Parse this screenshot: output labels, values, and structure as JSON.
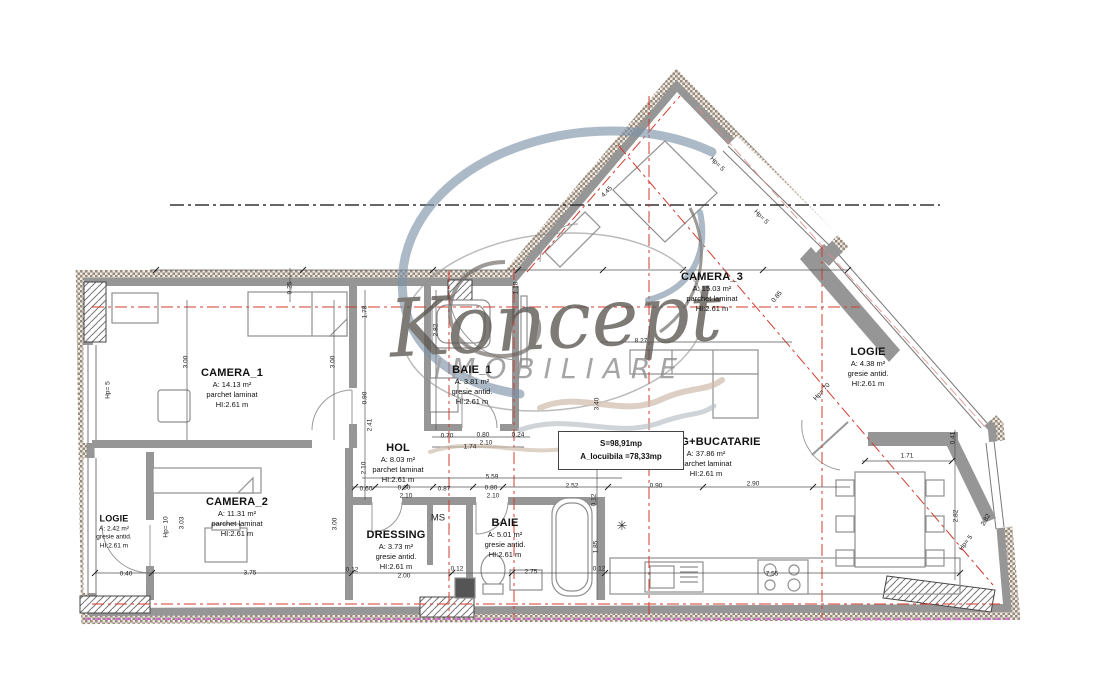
{
  "watermark": {
    "brand": "Koncept",
    "subtitle": "IMOBILIARE"
  },
  "summary_box": {
    "line1": "S=98,91mp",
    "line2": "A_locuibila =78,33mp"
  },
  "symbols": {
    "appliance": "✳"
  },
  "rooms": {
    "camera1": {
      "name": "CAMERA_1",
      "area": "A: 14.13 m²",
      "finish": "parchet laminat",
      "height": "HI:2.61 m"
    },
    "camera2": {
      "name": "CAMERA_2",
      "area": "A: 11.31 m²",
      "finish": "parchet laminat",
      "height": "HI:2.61 m"
    },
    "camera3": {
      "name": "CAMERA_3",
      "area": "A: 15.03 m²",
      "finish": "parchet laminat",
      "height": "HI:2.61 m"
    },
    "baie1": {
      "name": "BAIE_1",
      "area": "A: 3.81 m²",
      "finish": "gresie antid.",
      "height": "HI:2.61 m"
    },
    "hol": {
      "name": "HOL",
      "area": "A: 8.03 m²",
      "finish": "parchet laminat",
      "height": "HI:2.61 m"
    },
    "dressing": {
      "name": "DRESSING",
      "area": "A: 3.73 m²",
      "finish": "gresie antid.",
      "height": "HI:2.61 m"
    },
    "baie": {
      "name": "BAIE",
      "area": "A: 5.01 m²",
      "finish": "gresie antid.",
      "height": "HI:2.61 m"
    },
    "living": {
      "name": "LIVING+BUCATARIE",
      "area": "A: 37.86 m²",
      "finish": "parchet laminat",
      "height": "HI:2.61 m"
    },
    "logie_left": {
      "name": "LOGIE",
      "area": "A: 2.42 m²",
      "finish": "gresie antid.",
      "height": "HI:2.61 m"
    },
    "logie_right": {
      "name": "LOGIE",
      "area": "A: 4.38 m²",
      "finish": "gresie antid.",
      "height": "HI:2.61 m"
    },
    "ms": {
      "name": "MS"
    }
  },
  "dims": [
    {
      "t": "0.25",
      "x": 290,
      "y": 288,
      "r": -90
    },
    {
      "t": "3.00",
      "x": 186,
      "y": 362,
      "r": -90
    },
    {
      "t": "3.00",
      "x": 333,
      "y": 362,
      "r": -90
    },
    {
      "t": "1.78",
      "x": 365,
      "y": 312,
      "r": -90
    },
    {
      "t": "0.90",
      "x": 365,
      "y": 398,
      "r": -90
    },
    {
      "t": "2.41",
      "x": 370,
      "y": 425,
      "r": -90
    },
    {
      "t": "2.10",
      "x": 364,
      "y": 468,
      "r": -90
    },
    {
      "t": "2.82",
      "x": 436,
      "y": 330,
      "r": -90
    },
    {
      "t": "1.18",
      "x": 516,
      "y": 288,
      "r": -90
    },
    {
      "t": "0.70",
      "x": 447,
      "y": 436,
      "r": 0
    },
    {
      "t": "0.80",
      "x": 483,
      "y": 435,
      "r": 0
    },
    {
      "t": "2.10",
      "x": 486,
      "y": 443,
      "r": 0
    },
    {
      "t": "0.24",
      "x": 518,
      "y": 435,
      "r": 0
    },
    {
      "t": "1.74",
      "x": 470,
      "y": 447,
      "r": 0
    },
    {
      "t": "5.59",
      "x": 492,
      "y": 477,
      "r": 0
    },
    {
      "t": "0.60",
      "x": 366,
      "y": 489,
      "r": 0
    },
    {
      "t": "0.80",
      "x": 404,
      "y": 488,
      "r": 0
    },
    {
      "t": "2.10",
      "x": 406,
      "y": 496,
      "r": 0
    },
    {
      "t": "0.87",
      "x": 444,
      "y": 489,
      "r": 0
    },
    {
      "t": "0.80",
      "x": 491,
      "y": 488,
      "r": 0
    },
    {
      "t": "2.10",
      "x": 493,
      "y": 496,
      "r": 0
    },
    {
      "t": "2.52",
      "x": 572,
      "y": 486,
      "r": 0
    },
    {
      "t": "0.90",
      "x": 656,
      "y": 486,
      "r": 0
    },
    {
      "t": "2.90",
      "x": 753,
      "y": 484,
      "r": 0
    },
    {
      "t": "0.40",
      "x": 126,
      "y": 574,
      "r": 0
    },
    {
      "t": "3.75",
      "x": 250,
      "y": 573,
      "r": 0
    },
    {
      "t": "0.12",
      "x": 352,
      "y": 570,
      "r": 0
    },
    {
      "t": "2.00",
      "x": 404,
      "y": 576,
      "r": 0
    },
    {
      "t": "0.12",
      "x": 457,
      "y": 569,
      "r": 0
    },
    {
      "t": "2.75",
      "x": 531,
      "y": 572,
      "r": 0
    },
    {
      "t": "0.12",
      "x": 599,
      "y": 569,
      "r": 0
    },
    {
      "t": "7.55",
      "x": 772,
      "y": 574,
      "r": 0
    },
    {
      "t": "1.85",
      "x": 596,
      "y": 547,
      "r": -90
    },
    {
      "t": "0.12",
      "x": 594,
      "y": 500,
      "r": -90
    },
    {
      "t": "1.71",
      "x": 907,
      "y": 456,
      "r": 0
    },
    {
      "t": "0.41",
      "x": 953,
      "y": 438,
      "r": -90
    },
    {
      "t": "2.82",
      "x": 956,
      "y": 516,
      "r": -90
    },
    {
      "t": "4.45",
      "x": 607,
      "y": 192,
      "r": -45
    },
    {
      "t": "Hp= 5",
      "x": 717,
      "y": 164,
      "r": 45
    },
    {
      "t": "Hp= 5",
      "x": 761,
      "y": 217,
      "r": 45
    },
    {
      "t": "0.85",
      "x": 777,
      "y": 297,
      "r": -50
    },
    {
      "t": "8.27",
      "x": 641,
      "y": 341,
      "r": 0
    },
    {
      "t": "3.40",
      "x": 597,
      "y": 404,
      "r": -90
    },
    {
      "t": "Hp= 10",
      "x": 166,
      "y": 527,
      "r": -90
    },
    {
      "t": "3.03",
      "x": 182,
      "y": 523,
      "r": -90
    },
    {
      "t": "3.00",
      "x": 335,
      "y": 524,
      "r": -90
    },
    {
      "t": "Hp= 5",
      "x": 108,
      "y": 390,
      "r": -90
    },
    {
      "t": "Hp= 5",
      "x": 966,
      "y": 543,
      "r": -52
    },
    {
      "t": "Hp= 70",
      "x": 822,
      "y": 392,
      "r": -48
    },
    {
      "t": "2.82",
      "x": 986,
      "y": 520,
      "r": -60
    }
  ]
}
